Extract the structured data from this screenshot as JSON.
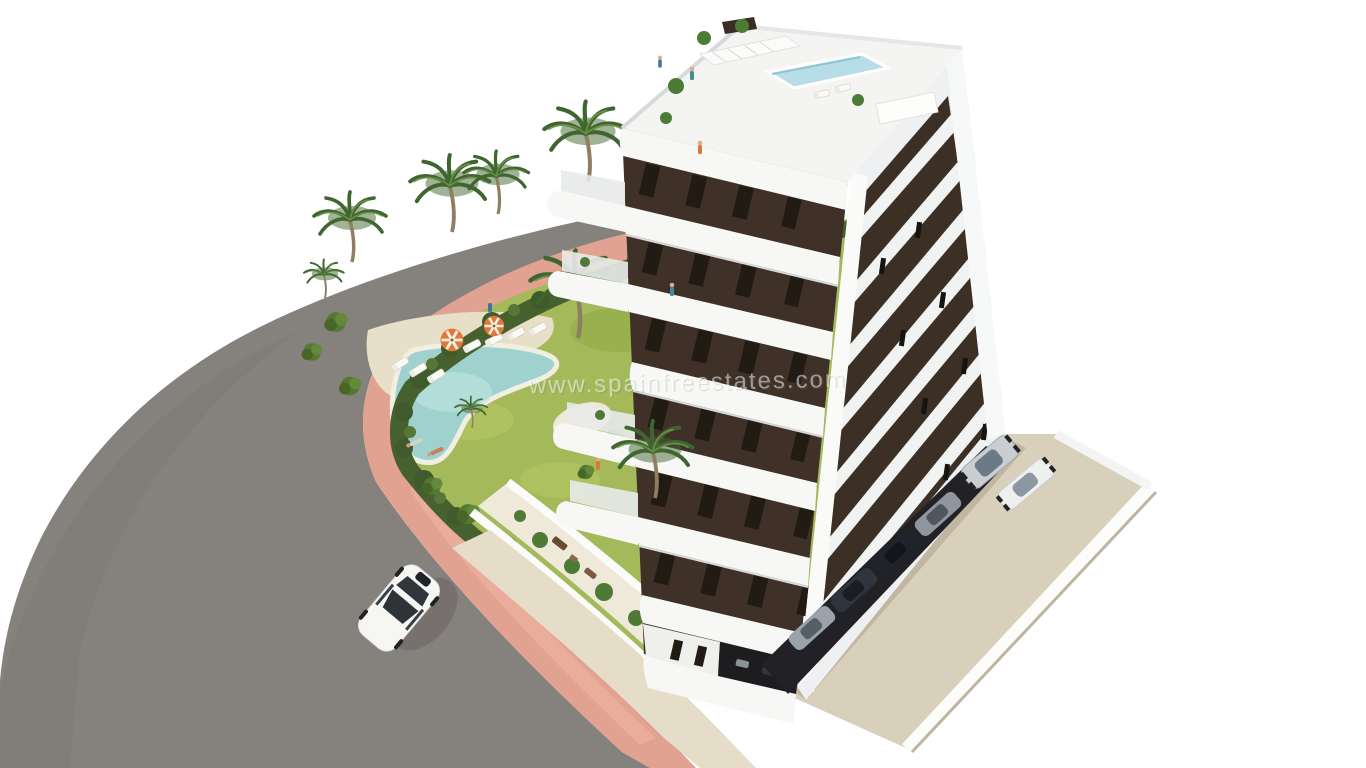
{
  "watermark": {
    "text": "www.spainfreestates.com"
  },
  "palette": {
    "background": "#ffffff",
    "road": "#85817d",
    "sidewalk": "#e2a291",
    "hedge": "#46602e",
    "lawn": "#a4b95a",
    "sand": "#e8dfc8",
    "pool_water": "#9fd2cf",
    "rooftop_pool": "#b7dde8",
    "building_white": "#f6f6f4",
    "building_brown": "#3f3128",
    "window_dark": "#221b14",
    "parking_concrete": "#d9d0bb",
    "walkway": "#e6ddc8",
    "car_white": "#f6f6f5",
    "umbrella_orange": "#e0763a"
  },
  "scene": {
    "description": "Aerial 3D architectural rendering of a modern white and brown apartment block with curved balconies, rooftop pool, landscaped garden with free-form swimming pool and palm trees, pink-edged road and parking area",
    "building_floors": 8,
    "palm_trees": 8,
    "garden_umbrellas": 2,
    "sun_loungers": 7,
    "parked_cars": 6,
    "cars_on_road": 1,
    "people_visible": 8
  }
}
